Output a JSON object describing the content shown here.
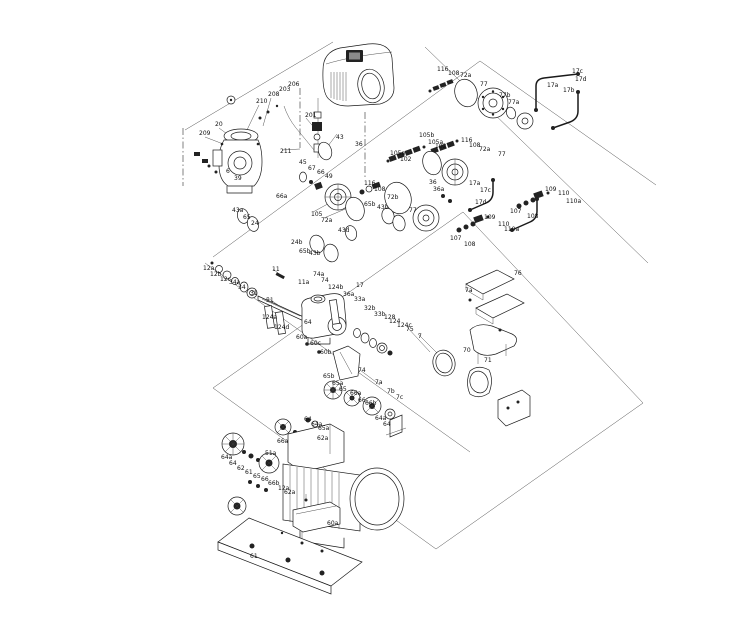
{
  "page": {
    "background": "#ffffff",
    "ink_color": "#1a1a1a"
  },
  "diagram": {
    "kind": "exploded-parts-diagram",
    "labels": [
      {
        "t": "209",
        "x": 199,
        "y": 135
      },
      {
        "t": "20",
        "x": 215,
        "y": 126
      },
      {
        "t": "210",
        "x": 256,
        "y": 103
      },
      {
        "t": "208",
        "x": 268,
        "y": 96
      },
      {
        "t": "203",
        "x": 279,
        "y": 91
      },
      {
        "t": "206",
        "x": 288,
        "y": 86
      },
      {
        "t": "201",
        "x": 305,
        "y": 117
      },
      {
        "t": "211",
        "x": 280,
        "y": 153
      },
      {
        "t": "6",
        "x": 226,
        "y": 173
      },
      {
        "t": "39",
        "x": 234,
        "y": 180
      },
      {
        "t": "43",
        "x": 336,
        "y": 139
      },
      {
        "t": "36",
        "x": 355,
        "y": 146
      },
      {
        "t": "43a",
        "x": 232,
        "y": 212
      },
      {
        "t": "65",
        "x": 243,
        "y": 219
      },
      {
        "t": "24",
        "x": 251,
        "y": 225
      },
      {
        "t": "45",
        "x": 299,
        "y": 164
      },
      {
        "t": "67",
        "x": 308,
        "y": 170
      },
      {
        "t": "66",
        "x": 317,
        "y": 174
      },
      {
        "t": "49",
        "x": 325,
        "y": 178
      },
      {
        "t": "66a",
        "x": 276,
        "y": 198
      },
      {
        "t": "105",
        "x": 311,
        "y": 216
      },
      {
        "t": "72a",
        "x": 321,
        "y": 222
      },
      {
        "t": "43d",
        "x": 338,
        "y": 232
      },
      {
        "t": "24b",
        "x": 291,
        "y": 244
      },
      {
        "t": "65b",
        "x": 299,
        "y": 253
      },
      {
        "t": "43b",
        "x": 309,
        "y": 255
      },
      {
        "t": "116",
        "x": 437,
        "y": 71
      },
      {
        "t": "108",
        "x": 448,
        "y": 75
      },
      {
        "t": "72a",
        "x": 460,
        "y": 77
      },
      {
        "t": "77",
        "x": 480,
        "y": 86
      },
      {
        "t": "77b",
        "x": 499,
        "y": 97
      },
      {
        "t": "77a",
        "x": 508,
        "y": 104
      },
      {
        "t": "17a",
        "x": 547,
        "y": 87
      },
      {
        "t": "17b",
        "x": 563,
        "y": 92
      },
      {
        "t": "17c",
        "x": 572,
        "y": 73
      },
      {
        "t": "17d",
        "x": 575,
        "y": 81
      },
      {
        "t": "105b",
        "x": 419,
        "y": 137
      },
      {
        "t": "105a",
        "x": 428,
        "y": 144
      },
      {
        "t": "102",
        "x": 435,
        "y": 148
      },
      {
        "t": "116",
        "x": 461,
        "y": 142
      },
      {
        "t": "108",
        "x": 469,
        "y": 147
      },
      {
        "t": "72a",
        "x": 479,
        "y": 151
      },
      {
        "t": "77",
        "x": 498,
        "y": 156
      },
      {
        "t": "105a",
        "x": 390,
        "y": 155
      },
      {
        "t": "102",
        "x": 400,
        "y": 161
      },
      {
        "t": "116",
        "x": 364,
        "y": 185
      },
      {
        "t": "108",
        "x": 374,
        "y": 191
      },
      {
        "t": "72b",
        "x": 387,
        "y": 199
      },
      {
        "t": "36",
        "x": 429,
        "y": 184
      },
      {
        "t": "36a",
        "x": 433,
        "y": 191
      },
      {
        "t": "17a",
        "x": 469,
        "y": 185
      },
      {
        "t": "17c",
        "x": 480,
        "y": 192
      },
      {
        "t": "17d",
        "x": 475,
        "y": 204
      },
      {
        "t": "77",
        "x": 409,
        "y": 212
      },
      {
        "t": "65b",
        "x": 364,
        "y": 206
      },
      {
        "t": "43b",
        "x": 377,
        "y": 209
      },
      {
        "t": "109",
        "x": 484,
        "y": 219
      },
      {
        "t": "110",
        "x": 498,
        "y": 226
      },
      {
        "t": "110a",
        "x": 504,
        "y": 231
      },
      {
        "t": "107",
        "x": 450,
        "y": 240
      },
      {
        "t": "108",
        "x": 464,
        "y": 246
      },
      {
        "t": "107",
        "x": 510,
        "y": 213
      },
      {
        "t": "108",
        "x": 527,
        "y": 218
      },
      {
        "t": "109",
        "x": 545,
        "y": 191
      },
      {
        "t": "110",
        "x": 558,
        "y": 195
      },
      {
        "t": "110a",
        "x": 566,
        "y": 203
      },
      {
        "t": "12a",
        "x": 203,
        "y": 270
      },
      {
        "t": "12b",
        "x": 210,
        "y": 276
      },
      {
        "t": "12c",
        "x": 220,
        "y": 281
      },
      {
        "t": "34a",
        "x": 229,
        "y": 284
      },
      {
        "t": "34",
        "x": 238,
        "y": 289
      },
      {
        "t": "31",
        "x": 250,
        "y": 295
      },
      {
        "t": "11",
        "x": 272,
        "y": 271
      },
      {
        "t": "51",
        "x": 266,
        "y": 302
      },
      {
        "t": "11a",
        "x": 298,
        "y": 284
      },
      {
        "t": "74a",
        "x": 313,
        "y": 276
      },
      {
        "t": "74",
        "x": 321,
        "y": 282
      },
      {
        "t": "124b",
        "x": 328,
        "y": 289
      },
      {
        "t": "17",
        "x": 356,
        "y": 287
      },
      {
        "t": "124a",
        "x": 262,
        "y": 319
      },
      {
        "t": "124d",
        "x": 274,
        "y": 329
      },
      {
        "t": "36a",
        "x": 343,
        "y": 296
      },
      {
        "t": "33a",
        "x": 354,
        "y": 301
      },
      {
        "t": "32b",
        "x": 364,
        "y": 310
      },
      {
        "t": "33b",
        "x": 374,
        "y": 316
      },
      {
        "t": "128",
        "x": 384,
        "y": 319
      },
      {
        "t": "124",
        "x": 389,
        "y": 323
      },
      {
        "t": "124c",
        "x": 397,
        "y": 327
      },
      {
        "t": "75",
        "x": 406,
        "y": 331
      },
      {
        "t": "7",
        "x": 418,
        "y": 338
      },
      {
        "t": "64",
        "x": 304,
        "y": 324
      },
      {
        "t": "60a",
        "x": 296,
        "y": 339
      },
      {
        "t": "60c",
        "x": 310,
        "y": 345
      },
      {
        "t": "60b",
        "x": 320,
        "y": 354
      },
      {
        "t": "74",
        "x": 358,
        "y": 372
      },
      {
        "t": "7a",
        "x": 375,
        "y": 384
      },
      {
        "t": "7b",
        "x": 387,
        "y": 393
      },
      {
        "t": "7c",
        "x": 396,
        "y": 399
      },
      {
        "t": "76",
        "x": 514,
        "y": 275
      },
      {
        "t": "7a",
        "x": 465,
        "y": 292
      },
      {
        "t": "70",
        "x": 463,
        "y": 352
      },
      {
        "t": "71",
        "x": 484,
        "y": 362
      },
      {
        "t": "65b",
        "x": 323,
        "y": 378
      },
      {
        "t": "65a",
        "x": 332,
        "y": 385
      },
      {
        "t": "65",
        "x": 339,
        "y": 391
      },
      {
        "t": "66a",
        "x": 350,
        "y": 395
      },
      {
        "t": "66",
        "x": 358,
        "y": 402
      },
      {
        "t": "66b",
        "x": 365,
        "y": 405
      },
      {
        "t": "64a",
        "x": 375,
        "y": 420
      },
      {
        "t": "64",
        "x": 383,
        "y": 426
      },
      {
        "t": "64",
        "x": 304,
        "y": 421
      },
      {
        "t": "64a",
        "x": 311,
        "y": 426
      },
      {
        "t": "62a",
        "x": 317,
        "y": 440
      },
      {
        "t": "66a",
        "x": 277,
        "y": 443
      },
      {
        "t": "65a",
        "x": 318,
        "y": 430
      },
      {
        "t": "51a",
        "x": 265,
        "y": 455
      },
      {
        "t": "64a",
        "x": 221,
        "y": 459
      },
      {
        "t": "64",
        "x": 229,
        "y": 465
      },
      {
        "t": "62",
        "x": 237,
        "y": 470
      },
      {
        "t": "61",
        "x": 245,
        "y": 474
      },
      {
        "t": "65",
        "x": 253,
        "y": 478
      },
      {
        "t": "66",
        "x": 261,
        "y": 481
      },
      {
        "t": "66b",
        "x": 268,
        "y": 485
      },
      {
        "t": "12a",
        "x": 278,
        "y": 490
      },
      {
        "t": "62a",
        "x": 284,
        "y": 494
      },
      {
        "t": "60a",
        "x": 327,
        "y": 525
      },
      {
        "t": "61",
        "x": 250,
        "y": 558
      }
    ]
  }
}
